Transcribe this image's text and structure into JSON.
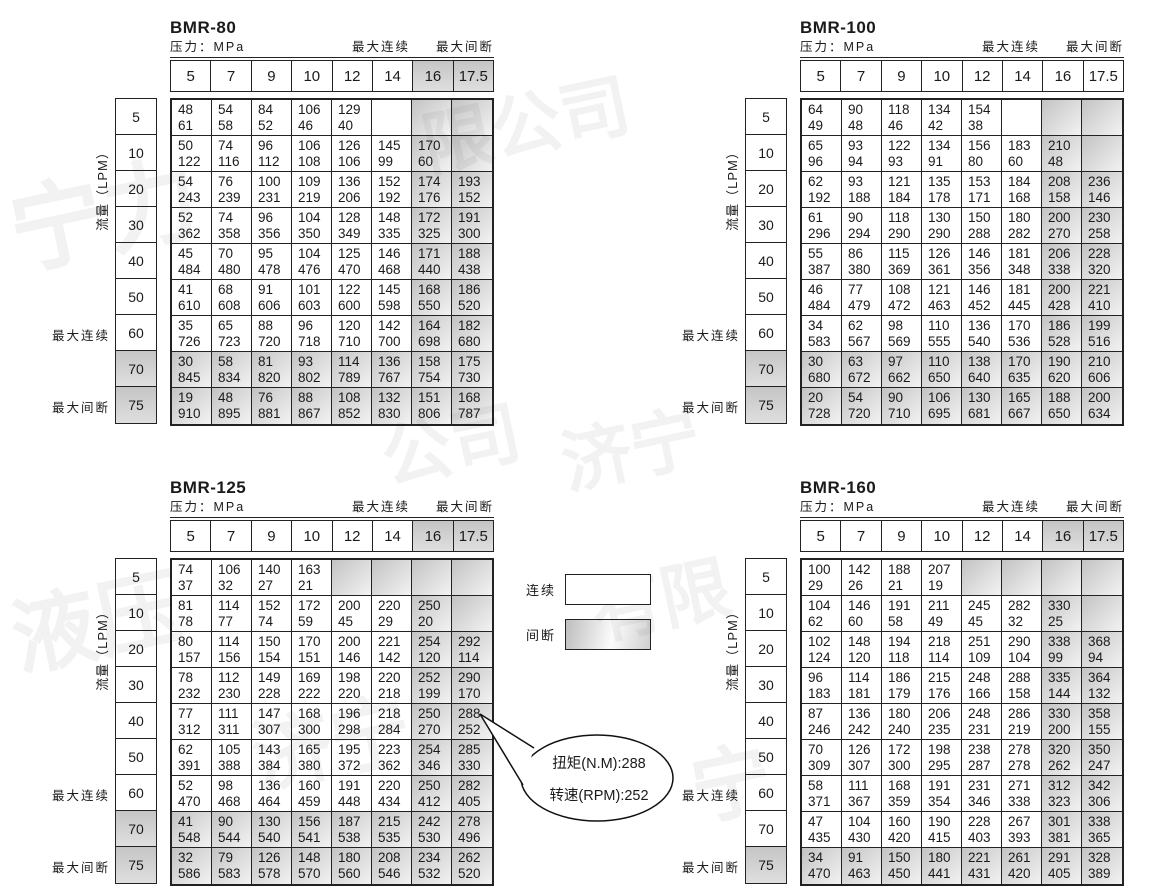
{
  "labels": {
    "pressure": "压力：MPa",
    "max_continuous": "最大连续",
    "max_intermittent": "最大间断",
    "flow_axis": "流量（LPM）"
  },
  "pressure_columns": [
    "5",
    "7",
    "9",
    "10",
    "12",
    "14",
    "16",
    "17.5"
  ],
  "flow_rows": [
    "5",
    "10",
    "20",
    "30",
    "40",
    "50",
    "60",
    "70",
    "75"
  ],
  "legend": {
    "continuous_label": "连续",
    "intermittent_label": "间断"
  },
  "callout": {
    "torque_line": "扭矩(N.M):288",
    "speed_line": "转速(RPM):252"
  },
  "colors": {
    "border": "#222222",
    "shade_dark": "#c3c3c3",
    "shade_light": "#ececec",
    "text": "#1a1a1a"
  },
  "watermarks": [
    {
      "text": "宁力",
      "x": 8,
      "y": 140,
      "size": 95,
      "rot": -12
    },
    {
      "text": "限公司",
      "x": 420,
      "y": 70,
      "size": 70,
      "rot": -12
    },
    {
      "text": "公司",
      "x": 380,
      "y": 390,
      "size": 70,
      "rot": -12
    },
    {
      "text": "济宁",
      "x": 560,
      "y": 395,
      "size": 70,
      "rot": -12
    },
    {
      "text": "液压",
      "x": 10,
      "y": 555,
      "size": 85,
      "rot": -12
    },
    {
      "text": "有限",
      "x": 590,
      "y": 545,
      "size": 70,
      "rot": -12
    },
    {
      "text": "济宁",
      "x": 250,
      "y": 680,
      "size": 80,
      "rot": -12
    },
    {
      "text": "宁",
      "x": 690,
      "y": 720,
      "size": 80,
      "rot": -12
    }
  ],
  "tables": [
    {
      "title": "BMR-80",
      "header_shaded": [
        6,
        7
      ],
      "shaded_cols": [
        6,
        7
      ],
      "shaded_rows": [
        7,
        8
      ],
      "extra_shaded": [],
      "cells": [
        [
          [
            48,
            61
          ],
          [
            54,
            58
          ],
          [
            84,
            52
          ],
          [
            106,
            46
          ],
          [
            129,
            40
          ],
          null,
          null,
          null
        ],
        [
          [
            50,
            122
          ],
          [
            74,
            116
          ],
          [
            96,
            112
          ],
          [
            106,
            108
          ],
          [
            126,
            106
          ],
          [
            145,
            99
          ],
          [
            170,
            60
          ],
          null
        ],
        [
          [
            54,
            243
          ],
          [
            76,
            239
          ],
          [
            100,
            231
          ],
          [
            109,
            219
          ],
          [
            136,
            206
          ],
          [
            152,
            192
          ],
          [
            174,
            176
          ],
          [
            193,
            152
          ]
        ],
        [
          [
            52,
            362
          ],
          [
            74,
            358
          ],
          [
            96,
            356
          ],
          [
            104,
            350
          ],
          [
            128,
            349
          ],
          [
            148,
            335
          ],
          [
            172,
            325
          ],
          [
            191,
            300
          ]
        ],
        [
          [
            45,
            484
          ],
          [
            70,
            480
          ],
          [
            95,
            478
          ],
          [
            104,
            476
          ],
          [
            125,
            470
          ],
          [
            146,
            468
          ],
          [
            171,
            440
          ],
          [
            188,
            438
          ]
        ],
        [
          [
            41,
            610
          ],
          [
            68,
            608
          ],
          [
            91,
            606
          ],
          [
            101,
            603
          ],
          [
            122,
            600
          ],
          [
            145,
            598
          ],
          [
            168,
            550
          ],
          [
            186,
            520
          ]
        ],
        [
          [
            35,
            726
          ],
          [
            65,
            723
          ],
          [
            88,
            720
          ],
          [
            96,
            718
          ],
          [
            120,
            710
          ],
          [
            142,
            700
          ],
          [
            164,
            698
          ],
          [
            182,
            680
          ]
        ],
        [
          [
            30,
            845
          ],
          [
            58,
            834
          ],
          [
            81,
            820
          ],
          [
            93,
            802
          ],
          [
            114,
            789
          ],
          [
            136,
            767
          ],
          [
            158,
            754
          ],
          [
            175,
            730
          ]
        ],
        [
          [
            19,
            910
          ],
          [
            48,
            895
          ],
          [
            76,
            881
          ],
          [
            88,
            867
          ],
          [
            108,
            852
          ],
          [
            132,
            830
          ],
          [
            151,
            806
          ],
          [
            168,
            787
          ]
        ]
      ]
    },
    {
      "title": "BMR-100",
      "header_shaded": [],
      "shaded_cols": [
        6,
        7
      ],
      "shaded_rows": [
        7,
        8
      ],
      "extra_shaded": [],
      "cells": [
        [
          [
            64,
            49
          ],
          [
            90,
            48
          ],
          [
            118,
            46
          ],
          [
            134,
            42
          ],
          [
            154,
            38
          ],
          null,
          null,
          null
        ],
        [
          [
            65,
            96
          ],
          [
            93,
            94
          ],
          [
            122,
            93
          ],
          [
            134,
            91
          ],
          [
            156,
            80
          ],
          [
            183,
            60
          ],
          [
            210,
            48
          ],
          null
        ],
        [
          [
            62,
            192
          ],
          [
            93,
            188
          ],
          [
            121,
            184
          ],
          [
            135,
            178
          ],
          [
            153,
            171
          ],
          [
            184,
            168
          ],
          [
            208,
            158
          ],
          [
            236,
            146
          ]
        ],
        [
          [
            61,
            296
          ],
          [
            90,
            294
          ],
          [
            118,
            290
          ],
          [
            130,
            290
          ],
          [
            150,
            288
          ],
          [
            180,
            282
          ],
          [
            200,
            270
          ],
          [
            230,
            258
          ]
        ],
        [
          [
            55,
            387
          ],
          [
            86,
            380
          ],
          [
            115,
            369
          ],
          [
            126,
            361
          ],
          [
            146,
            356
          ],
          [
            181,
            348
          ],
          [
            206,
            338
          ],
          [
            228,
            320
          ]
        ],
        [
          [
            46,
            484
          ],
          [
            77,
            479
          ],
          [
            108,
            472
          ],
          [
            121,
            463
          ],
          [
            146,
            452
          ],
          [
            181,
            445
          ],
          [
            200,
            428
          ],
          [
            221,
            410
          ]
        ],
        [
          [
            34,
            583
          ],
          [
            62,
            567
          ],
          [
            98,
            569
          ],
          [
            110,
            555
          ],
          [
            136,
            540
          ],
          [
            170,
            536
          ],
          [
            186,
            528
          ],
          [
            199,
            516
          ]
        ],
        [
          [
            30,
            680
          ],
          [
            63,
            672
          ],
          [
            97,
            662
          ],
          [
            110,
            650
          ],
          [
            138,
            640
          ],
          [
            170,
            635
          ],
          [
            190,
            620
          ],
          [
            210,
            606
          ]
        ],
        [
          [
            20,
            728
          ],
          [
            54,
            720
          ],
          [
            90,
            710
          ],
          [
            106,
            695
          ],
          [
            130,
            681
          ],
          [
            165,
            667
          ],
          [
            188,
            650
          ],
          [
            200,
            634
          ]
        ]
      ]
    },
    {
      "title": "BMR-125",
      "header_shaded": [
        6,
        7
      ],
      "shaded_cols": [
        6,
        7
      ],
      "shaded_rows": [
        7,
        8
      ],
      "extra_shaded": [
        [
          0,
          4
        ],
        [
          0,
          5
        ]
      ],
      "cells": [
        [
          [
            74,
            37
          ],
          [
            106,
            32
          ],
          [
            140,
            27
          ],
          [
            163,
            21
          ],
          null,
          null,
          null,
          null
        ],
        [
          [
            81,
            78
          ],
          [
            114,
            77
          ],
          [
            152,
            74
          ],
          [
            172,
            59
          ],
          [
            200,
            45
          ],
          [
            220,
            29
          ],
          [
            250,
            20
          ],
          null
        ],
        [
          [
            80,
            157
          ],
          [
            114,
            156
          ],
          [
            150,
            154
          ],
          [
            170,
            151
          ],
          [
            200,
            146
          ],
          [
            221,
            142
          ],
          [
            254,
            120
          ],
          [
            292,
            114
          ]
        ],
        [
          [
            78,
            232
          ],
          [
            112,
            230
          ],
          [
            149,
            228
          ],
          [
            169,
            222
          ],
          [
            198,
            220
          ],
          [
            220,
            218
          ],
          [
            252,
            199
          ],
          [
            290,
            170
          ]
        ],
        [
          [
            77,
            312
          ],
          [
            111,
            311
          ],
          [
            147,
            307
          ],
          [
            168,
            300
          ],
          [
            196,
            298
          ],
          [
            218,
            284
          ],
          [
            250,
            270
          ],
          [
            288,
            252
          ]
        ],
        [
          [
            62,
            391
          ],
          [
            105,
            388
          ],
          [
            143,
            384
          ],
          [
            165,
            380
          ],
          [
            195,
            372
          ],
          [
            223,
            362
          ],
          [
            254,
            346
          ],
          [
            285,
            330
          ]
        ],
        [
          [
            52,
            470
          ],
          [
            98,
            468
          ],
          [
            136,
            464
          ],
          [
            160,
            459
          ],
          [
            191,
            448
          ],
          [
            220,
            434
          ],
          [
            250,
            412
          ],
          [
            282,
            405
          ]
        ],
        [
          [
            41,
            548
          ],
          [
            90,
            544
          ],
          [
            130,
            540
          ],
          [
            156,
            541
          ],
          [
            187,
            538
          ],
          [
            215,
            535
          ],
          [
            242,
            530
          ],
          [
            278,
            496
          ]
        ],
        [
          [
            32,
            586
          ],
          [
            79,
            583
          ],
          [
            126,
            578
          ],
          [
            148,
            570
          ],
          [
            180,
            560
          ],
          [
            208,
            546
          ],
          [
            234,
            532
          ],
          [
            262,
            520
          ]
        ]
      ]
    },
    {
      "title": "BMR-160",
      "header_shaded": [
        6,
        7
      ],
      "shaded_cols": [
        6,
        7
      ],
      "shaded_rows": [
        8
      ],
      "extra_shaded": [
        [
          0,
          4
        ],
        [
          0,
          5
        ]
      ],
      "cells": [
        [
          [
            100,
            29
          ],
          [
            142,
            26
          ],
          [
            188,
            21
          ],
          [
            207,
            19
          ],
          null,
          null,
          null,
          null
        ],
        [
          [
            104,
            62
          ],
          [
            146,
            60
          ],
          [
            191,
            58
          ],
          [
            211,
            49
          ],
          [
            245,
            45
          ],
          [
            282,
            32
          ],
          [
            330,
            25
          ],
          null
        ],
        [
          [
            102,
            124
          ],
          [
            148,
            120
          ],
          [
            194,
            118
          ],
          [
            218,
            114
          ],
          [
            251,
            109
          ],
          [
            290,
            104
          ],
          [
            338,
            99
          ],
          [
            368,
            94
          ]
        ],
        [
          [
            96,
            183
          ],
          [
            114,
            181
          ],
          [
            186,
            179
          ],
          [
            215,
            176
          ],
          [
            248,
            166
          ],
          [
            288,
            158
          ],
          [
            335,
            144
          ],
          [
            364,
            132
          ]
        ],
        [
          [
            87,
            246
          ],
          [
            136,
            242
          ],
          [
            180,
            240
          ],
          [
            206,
            235
          ],
          [
            248,
            231
          ],
          [
            286,
            219
          ],
          [
            330,
            200
          ],
          [
            358,
            155
          ]
        ],
        [
          [
            70,
            309
          ],
          [
            126,
            307
          ],
          [
            172,
            300
          ],
          [
            198,
            295
          ],
          [
            238,
            287
          ],
          [
            278,
            278
          ],
          [
            320,
            262
          ],
          [
            350,
            247
          ]
        ],
        [
          [
            58,
            371
          ],
          [
            111,
            367
          ],
          [
            168,
            359
          ],
          [
            191,
            354
          ],
          [
            231,
            346
          ],
          [
            271,
            338
          ],
          [
            312,
            323
          ],
          [
            342,
            306
          ]
        ],
        [
          [
            47,
            435
          ],
          [
            104,
            430
          ],
          [
            160,
            420
          ],
          [
            190,
            415
          ],
          [
            228,
            403
          ],
          [
            267,
            393
          ],
          [
            301,
            381
          ],
          [
            338,
            365
          ]
        ],
        [
          [
            34,
            470
          ],
          [
            91,
            463
          ],
          [
            150,
            450
          ],
          [
            180,
            441
          ],
          [
            221,
            431
          ],
          [
            261,
            420
          ],
          [
            291,
            405
          ],
          [
            328,
            389
          ]
        ]
      ]
    }
  ]
}
